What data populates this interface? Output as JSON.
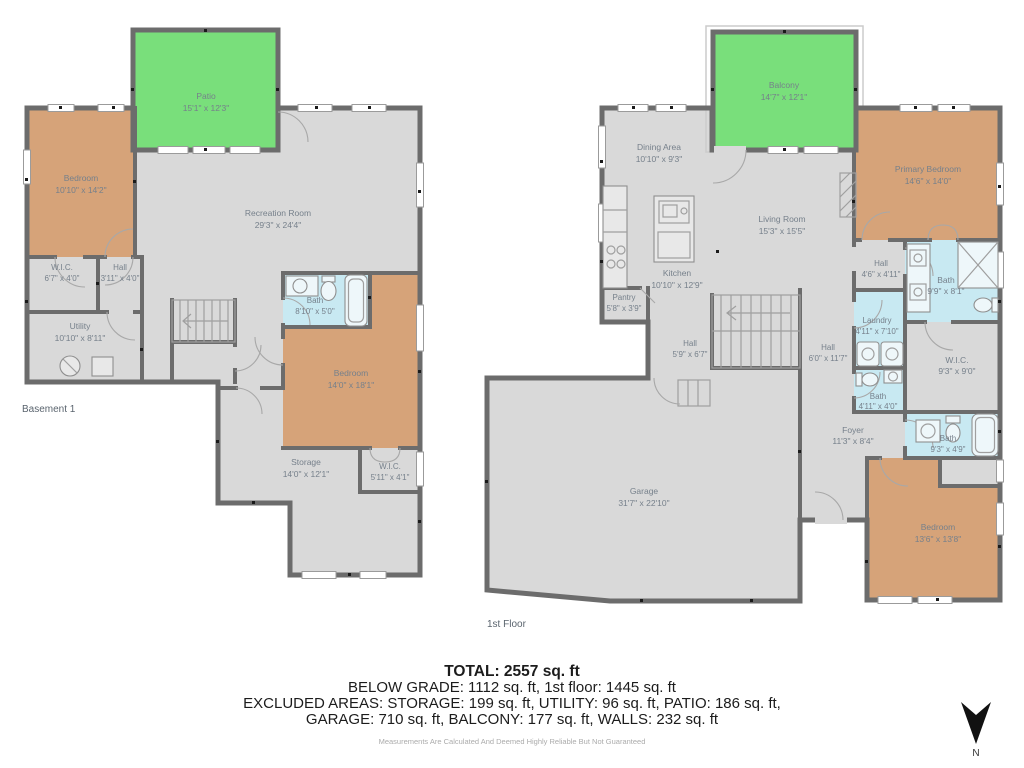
{
  "basement": {
    "floor_label": "Basement 1",
    "rooms": {
      "patio": {
        "name": "Patio",
        "dims": "15'1\" x 12'3\""
      },
      "bedroom1": {
        "name": "Bedroom",
        "dims": "10'10\" x 14'2\""
      },
      "wic": {
        "name": "W.I.C.",
        "dims": "6'7\" x 4'0\""
      },
      "hall": {
        "name": "Hall",
        "dims": "3'11\" x 4'0\""
      },
      "utility": {
        "name": "Utility",
        "dims": "10'10\" x 8'11\""
      },
      "recreation": {
        "name": "Recreation Room",
        "dims": "29'3\" x 24'4\""
      },
      "bath": {
        "name": "Bath",
        "dims": "8'10\" x 5'0\""
      },
      "bedroom2": {
        "name": "Bedroom",
        "dims": "14'0\" x 18'1\""
      },
      "storage": {
        "name": "Storage",
        "dims": "14'0\" x 12'1\""
      },
      "wic2": {
        "name": "W.I.C.",
        "dims": "5'11\" x 4'1\""
      }
    }
  },
  "first_floor": {
    "floor_label": "1st Floor",
    "rooms": {
      "balcony": {
        "name": "Balcony",
        "dims": "14'7\" x 12'1\""
      },
      "dining": {
        "name": "Dining Area",
        "dims": "10'10\" x 9'3\""
      },
      "primary": {
        "name": "Primary Bedroom",
        "dims": "14'6\" x 14'0\""
      },
      "living": {
        "name": "Living Room",
        "dims": "15'3\" x 15'5\""
      },
      "kitchen": {
        "name": "Kitchen",
        "dims": "10'10\" x 12'9\""
      },
      "pantry": {
        "name": "Pantry",
        "dims": "5'8\" x 3'9\""
      },
      "hall1": {
        "name": "Hall",
        "dims": "4'6\" x 4'11\""
      },
      "bath1": {
        "name": "Bath",
        "dims": "9'9\" x 8'1\""
      },
      "laundry": {
        "name": "Laundry",
        "dims": "4'11\" x 7'10\""
      },
      "hall2": {
        "name": "Hall",
        "dims": "5'9\" x 6'7\""
      },
      "hall3": {
        "name": "Hall",
        "dims": "6'0\" x 11'7\""
      },
      "bath2": {
        "name": "Bath",
        "dims": "4'11\" x 4'0\""
      },
      "wic": {
        "name": "W.I.C.",
        "dims": "9'3\" x 9'0\""
      },
      "foyer": {
        "name": "Foyer",
        "dims": "11'3\" x 8'4\""
      },
      "bath3": {
        "name": "Bath",
        "dims": "9'3\" x 4'9\""
      },
      "garage": {
        "name": "Garage",
        "dims": "31'7\" x 22'10\""
      },
      "bedroom": {
        "name": "Bedroom",
        "dims": "13'6\" x 13'8\""
      }
    }
  },
  "summary": {
    "total": "TOTAL: 2557 sq. ft",
    "line1": "BELOW GRADE: 1112 sq. ft, 1st floor: 1445 sq. ft",
    "line2": "EXCLUDED AREAS: STORAGE: 199 sq. ft, UTILITY: 96 sq. ft, PATIO: 186 sq. ft,",
    "line3": "GARAGE: 710 sq. ft, BALCONY: 177 sq. ft, WALLS: 232 sq. ft",
    "disclaimer": "Measurements Are Calculated And Deemed Highly Reliable But Not Guaranteed"
  },
  "compass": {
    "label": "N"
  },
  "colors": {
    "wall": "#6c6c6c",
    "floor_gray": "#d9d9d9",
    "bedroom_tan": "#d6a379",
    "bath_blue": "#c8e9f2",
    "outdoor_green": "#79df7b",
    "label_gray": "#76808b"
  }
}
